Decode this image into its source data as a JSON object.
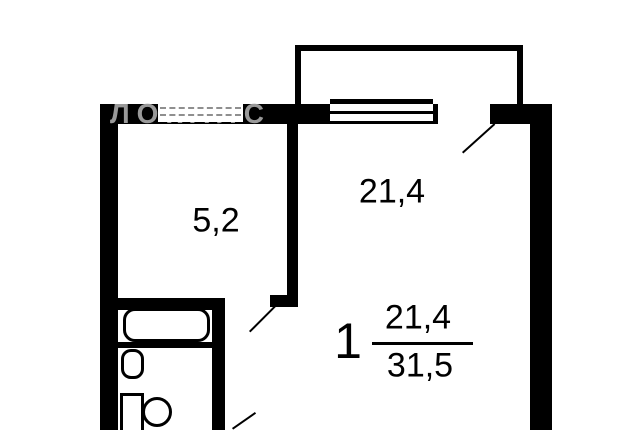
{
  "document_type": "apartment-floor-plan",
  "watermark_text": "ЛОКАЛС",
  "rooms": {
    "living_room": {
      "area": "21,4"
    },
    "small_room": {
      "area": "5,2"
    }
  },
  "area_summary": {
    "room_count": "1",
    "living_area": "21,4",
    "total_area": "31,5"
  },
  "fixtures": [
    "balcony",
    "bathtub",
    "sink",
    "toilet",
    "window",
    "door-swing"
  ],
  "colors": {
    "wall": "#000000",
    "background": "#ffffff",
    "watermark": "#999999",
    "text": "#000000",
    "window_dash": "#8f8f8f"
  }
}
